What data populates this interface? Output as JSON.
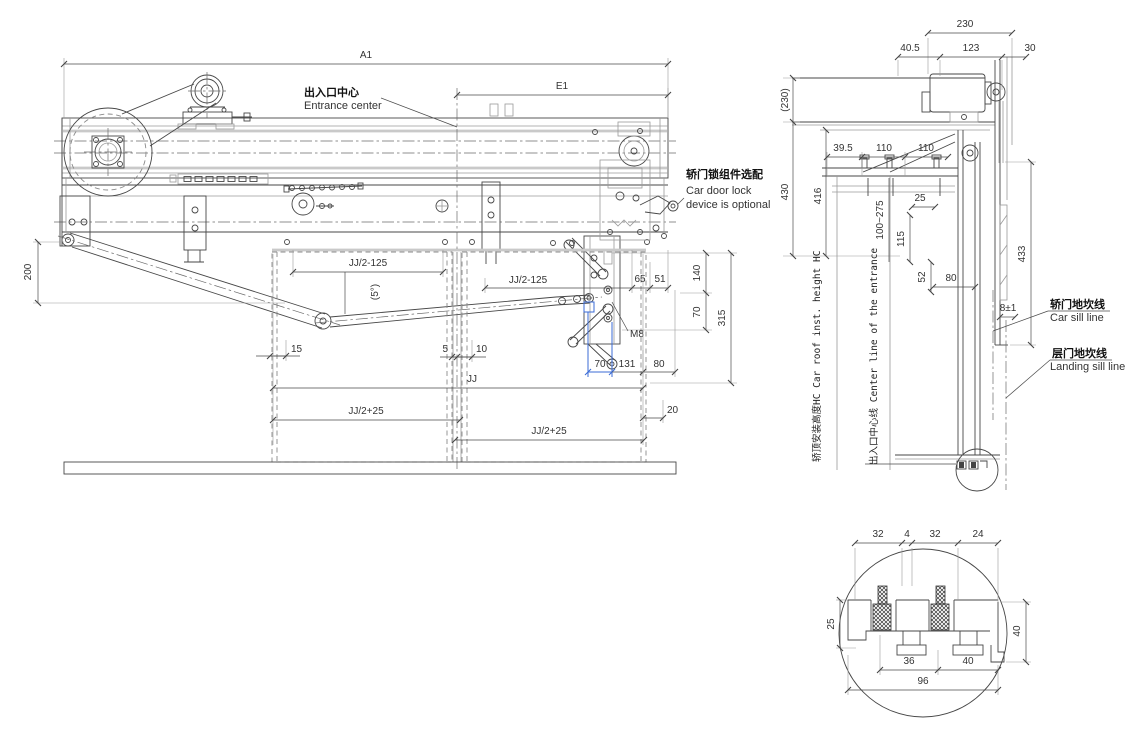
{
  "front": {
    "a1": "A1",
    "e1": "E1",
    "entrance_center_zh": "出入口中心",
    "entrance_center_en": "Entrance center",
    "lock_zh": "轿门锁组件选配",
    "lock_en1": "Car door lock",
    "lock_en2": "device is optional",
    "d200": "200",
    "jj2m125_left": "JJ/2-125",
    "jj2m125_right": "JJ/2-125",
    "angle5": "(5°)",
    "d65": "65",
    "d51": "51",
    "d140": "140",
    "d70_right": "70",
    "d315": "315",
    "m8": "M8",
    "d15": "15",
    "d5": "5",
    "d10": "10",
    "jj": "JJ",
    "jj2p25_left": "JJ/2+25",
    "jj2p25_right": "JJ/2+25",
    "d70_blue": "70",
    "d131": "131",
    "d80": "80",
    "d20": "20"
  },
  "side": {
    "d230": "230",
    "d40_5": "40.5",
    "d123": "123",
    "d30": "30",
    "d230_ref": "(230)",
    "d430": "430",
    "d416": "416",
    "d39_5": "39.5",
    "d110a": "110",
    "d110b": "110",
    "d100_275": "100~275",
    "d25": "25",
    "d115": "115",
    "d52": "52",
    "d80": "80",
    "d433": "433",
    "d8_1": "8±1",
    "roof_height_label": "轿顶安装高度HC Car roof inst. height HC",
    "entrance_center_line_label": "出入口中心线 Center line of the entrance",
    "car_sill_zh": "轿门地坎线",
    "car_sill_en": "Car sill line",
    "landing_sill_zh": "层门地坎线",
    "landing_sill_en": "Landing sill line"
  },
  "detail": {
    "d32a": "32",
    "d4": "4",
    "d32b": "32",
    "d24": "24",
    "d25": "25",
    "d36": "36",
    "d40_bottom": "40",
    "d40_right": "40",
    "d96": "96"
  },
  "colors": {
    "line": "#474747",
    "light": "#9a9a9a",
    "band": "#c9c9c9",
    "accent_blue": "#3b6bd6",
    "background": "#ffffff"
  }
}
